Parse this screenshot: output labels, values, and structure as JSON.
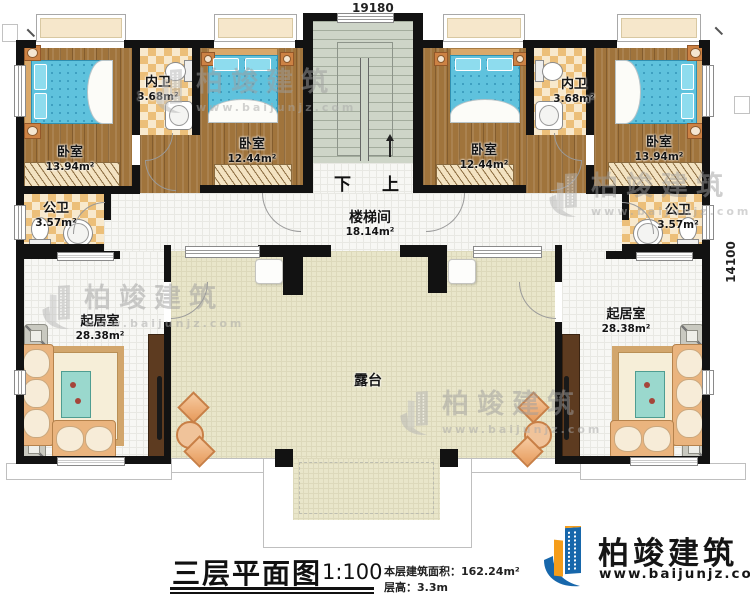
{
  "dimensions": {
    "top": "19180",
    "right": "14100"
  },
  "rooms": {
    "bedroom_left_outer": {
      "name": "卧室",
      "area": "13.94m²"
    },
    "bedroom_left_inner": {
      "name": "卧室",
      "area": "12.44m²"
    },
    "bedroom_right_inner": {
      "name": "卧室",
      "area": "12.44m²"
    },
    "bedroom_right_outer": {
      "name": "卧室",
      "area": "13.94m²"
    },
    "ensuite_left": {
      "name": "内卫",
      "area": "3.68m²"
    },
    "ensuite_right": {
      "name": "内卫",
      "area": "3.68m²"
    },
    "public_bath_left": {
      "name": "公卫",
      "area": "3.57m²"
    },
    "public_bath_right": {
      "name": "公卫",
      "area": "3.57m²"
    },
    "stair_hall": {
      "name": "楼梯间",
      "area": "18.14m²"
    },
    "living_left": {
      "name": "起居室",
      "area": "28.38m²"
    },
    "living_right": {
      "name": "起居室",
      "area": "28.38m²"
    },
    "terrace": {
      "name": "露台"
    }
  },
  "stairs": {
    "down": "下",
    "up": "上"
  },
  "title_block": {
    "title": "三层平面图",
    "scale": "1:100",
    "floor_area_label": "本层建筑面积：",
    "floor_area_value": "162.24m²",
    "floor_height_label": "层高：",
    "floor_height_value": "3.3m"
  },
  "logo": {
    "name": "柏竣建筑",
    "website": "www.baijunjz.com"
  },
  "watermark": {
    "name": "柏竣建筑",
    "website": "www.baijunjz.com"
  },
  "colors": {
    "wall": "#121212",
    "wood_floor": "#a0743c",
    "bath_checker": "#ecbf79",
    "terrace_floor": "#e9e6ca",
    "stair_floor": "#ced5c8",
    "bed": "#5fc2dd",
    "logo_blue": "#1767ab",
    "logo_orange": "#f59d1a"
  }
}
